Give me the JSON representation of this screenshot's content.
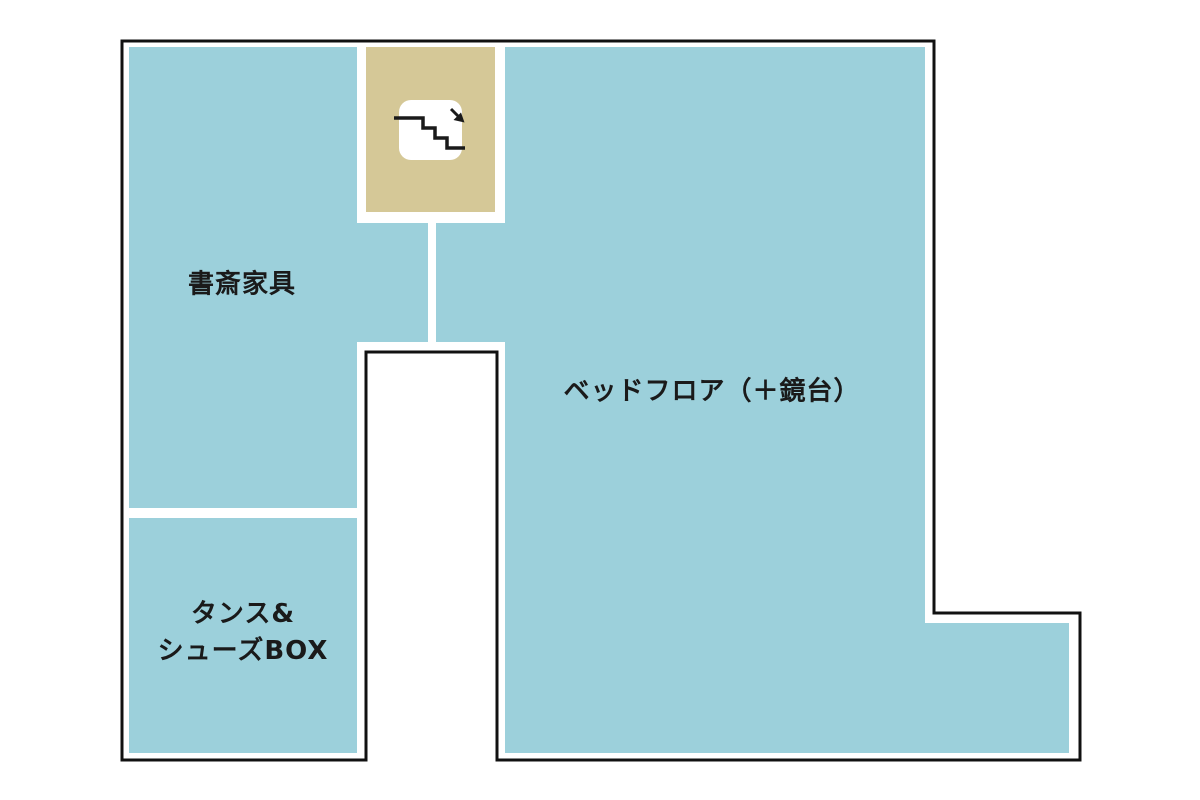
{
  "colors": {
    "page_background": "#ffffff",
    "room_fill": "#9cd0db",
    "stairs_fill": "#d5c897",
    "outline": "#111111",
    "label_text": "#1a1a1a",
    "stairs_icon_background": "#ffffff",
    "stairs_icon_stroke": "#1a1a1a"
  },
  "rooms": {
    "study": {
      "label": "書斎家具"
    },
    "tansu_shoes": {
      "label_line1": "タンス&",
      "label_line2": "シューズBOX"
    },
    "bed_floor": {
      "label": "ベッドフロア（＋鏡台）"
    },
    "stairs": {
      "icon": "stairs-down-icon"
    }
  }
}
